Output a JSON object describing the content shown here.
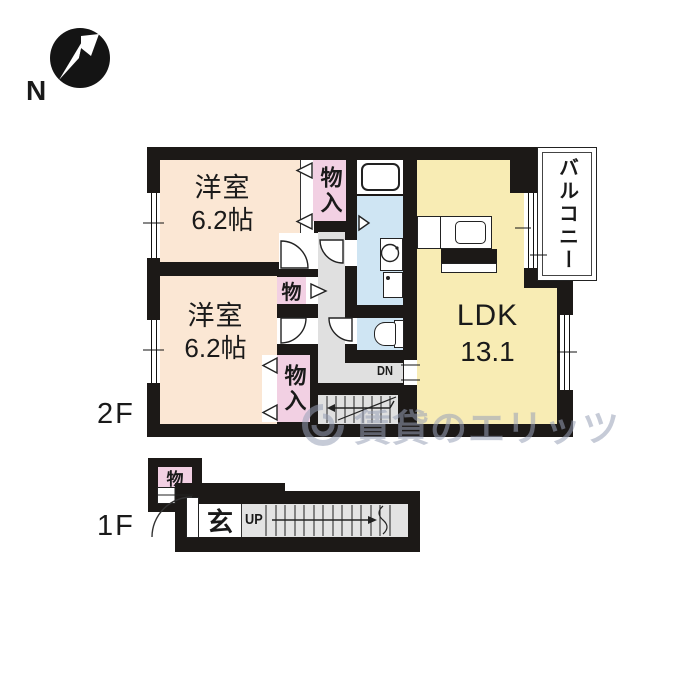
{
  "compass": {
    "direction_label": "N"
  },
  "floor2": {
    "floor_label": "2F",
    "bedroom1": {
      "name": "洋室",
      "size": "6.2帖"
    },
    "bedroom2": {
      "name": "洋室",
      "size": "6.2帖"
    },
    "closet1": {
      "label": "物入"
    },
    "closet2": {
      "label": "物入"
    },
    "closet_small": {
      "label": "物"
    },
    "ldk": {
      "name": "LDK",
      "size": "13.1"
    },
    "balcony": {
      "label": "バルコニー"
    },
    "stairs": {
      "label": "DN"
    }
  },
  "floor1": {
    "floor_label": "1F",
    "entrance": {
      "label": "玄"
    },
    "closet": {
      "label": "物"
    },
    "stairs": {
      "label": "UP"
    }
  },
  "watermark": {
    "text": "賃貸のエリッツ"
  },
  "colors": {
    "wall": "#1c1917",
    "bedroom_fill": "#fbe7d4",
    "closet_fill": "#f2d0e3",
    "ldk_fill": "#f8ecb4",
    "water_fill": "#cfe5f3",
    "hall_fill": "#e0e0e0",
    "balcony_fill": "#ffffff",
    "watermark_color": "#99a1b8"
  }
}
